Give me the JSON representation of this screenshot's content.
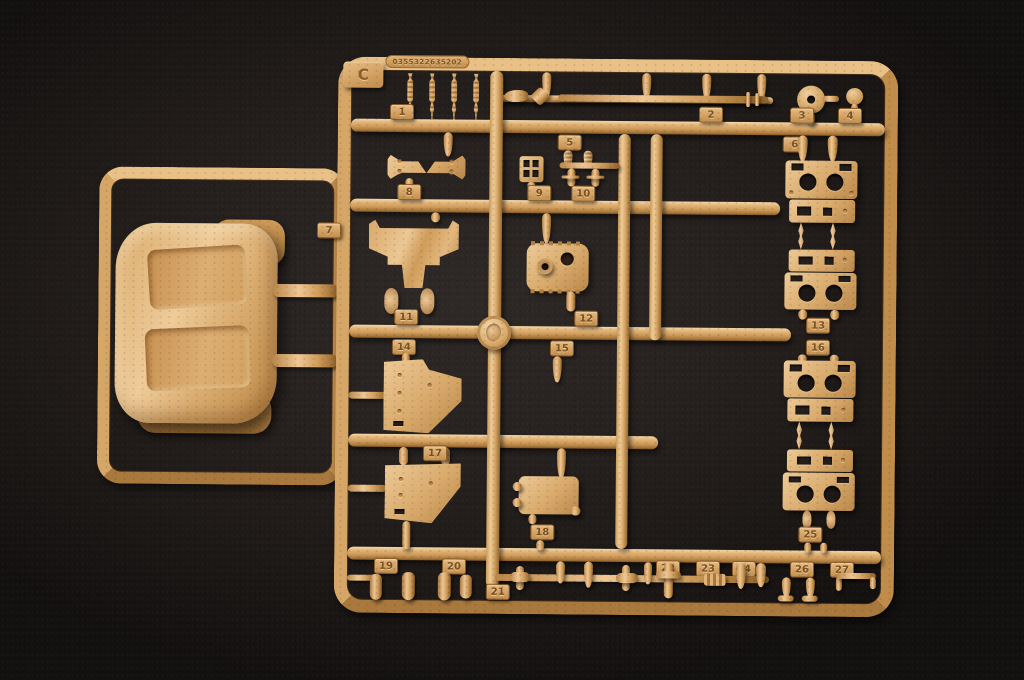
{
  "scene": {
    "description": "Photograph of a sand-colored injection-molded model kit sprue (runner) lying on a dark gray textured surface",
    "background_color": "#1d1917"
  },
  "sprue": {
    "letter": "C",
    "mold_code": "0355322635202",
    "plastic_color": "#d7a767",
    "plastic_highlight": "#f4d8a8",
    "plastic_shadow": "#8a5c28",
    "part_tags": [
      "1",
      "2",
      "3",
      "4",
      "5",
      "6",
      "7",
      "8",
      "9",
      "10",
      "11",
      "12",
      "13",
      "14",
      "15",
      "16",
      "17",
      "18",
      "19",
      "20",
      "21",
      "22",
      "23",
      "24",
      "25",
      "26",
      "27"
    ]
  }
}
